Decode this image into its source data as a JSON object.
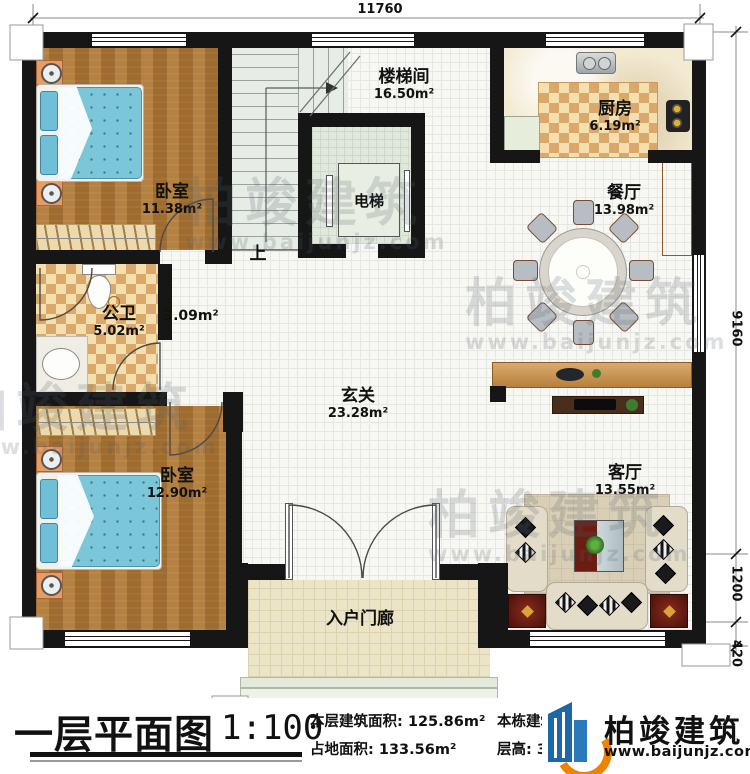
{
  "plan": {
    "rooms": [
      {
        "id": "bedroom1",
        "name": "卧室",
        "area": "11.38m²"
      },
      {
        "id": "stairwell",
        "name": "楼梯间",
        "area": "16.50m²"
      },
      {
        "id": "kitchen",
        "name": "厨房",
        "area": "6.19m²"
      },
      {
        "id": "dining",
        "name": "餐厅",
        "area": "13.98m²"
      },
      {
        "id": "elevator",
        "name": "电梯",
        "area": ""
      },
      {
        "id": "bathroom",
        "name": "公卫",
        "area": "5.02m²"
      },
      {
        "id": "corridor",
        "name": "",
        "area": "3.09m²"
      },
      {
        "id": "foyer",
        "name": "玄关",
        "area": "23.28m²"
      },
      {
        "id": "bedroom2",
        "name": "卧室",
        "area": "12.90m²"
      },
      {
        "id": "living",
        "name": "客厅",
        "area": "13.55m²"
      },
      {
        "id": "porch",
        "name": "入户门廊",
        "area": ""
      }
    ],
    "stair_up_label": "上",
    "dimensions": {
      "top_width": "11760",
      "right_height": "9160",
      "right_porch": "1200",
      "right_step": "420"
    }
  },
  "titleblock": {
    "title": "一层平面图",
    "scale": "1:100",
    "floor_area_label": "本层建筑面积:",
    "floor_area_value": "125.86m²",
    "site_area_label": "占地面积:",
    "site_area_value": "133.56m²",
    "total_area_label": "本栋建筑面积:",
    "height_label": "层高:",
    "height_value": "3.6m"
  },
  "watermark": {
    "brand": "柏竣建筑",
    "url": "www.baijunjz.com"
  },
  "colors": {
    "wall": "#161616",
    "wood_floor": "#aa7433",
    "tile_checker": "#d9a86a",
    "bed_teal": "#7cc6da",
    "cabinet_brown": "#c08a4e",
    "sofa_beige": "#e3dcc8",
    "accent_red": "#6b1d12",
    "logo_blue": "#1b67a8",
    "logo_orange": "#ee8300"
  }
}
